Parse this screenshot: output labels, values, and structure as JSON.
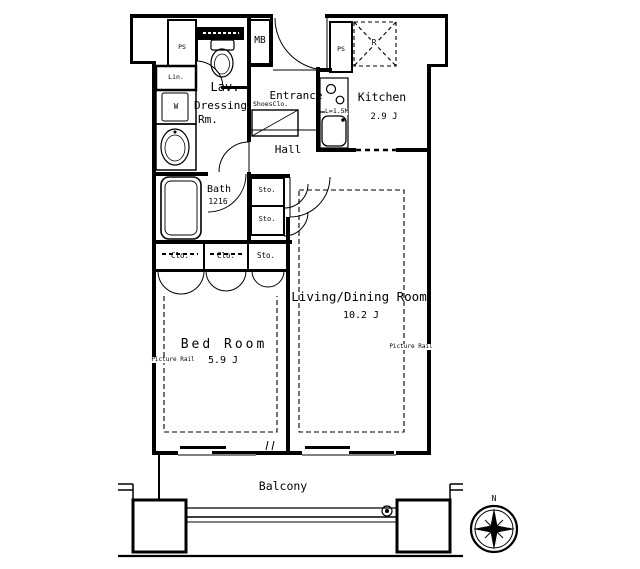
{
  "title": "Apartment floor plan 1LDK",
  "colors": {
    "line": "#000000",
    "background": "#ffffff"
  },
  "labels": {
    "lav": "Lav.",
    "dressing_line1": "Dressing",
    "dressing_line2": "Rm.",
    "bath": "Bath",
    "bath_size": "1216",
    "entrance": "Entrance",
    "shoes_closet": "ShoesClo.",
    "hall": "Hall",
    "kitchen": "Kitchen",
    "kitchen_area": "2.9 J",
    "kitchen_counter": "L=1.5M",
    "meter_box": "MB",
    "pipe_space_left": "PS",
    "pipe_space_kitchen": "PS",
    "linen": "Lin.",
    "washer": "W",
    "refrigerator": "R",
    "storage_1": "Sto.",
    "storage_2": "Sto.",
    "storage_3": "Sto.",
    "closet_1": "Clo.",
    "closet_2": "Clo.",
    "living_dining": "Living/Dining Room",
    "living_dining_area": "10.2 J",
    "bedroom": "Bed Room",
    "bedroom_area": "5.9 J",
    "picture_rail_left": "Picture Rail",
    "picture_rail_right": "Picture Rail",
    "balcony": "Balcony",
    "compass_north": "N"
  }
}
